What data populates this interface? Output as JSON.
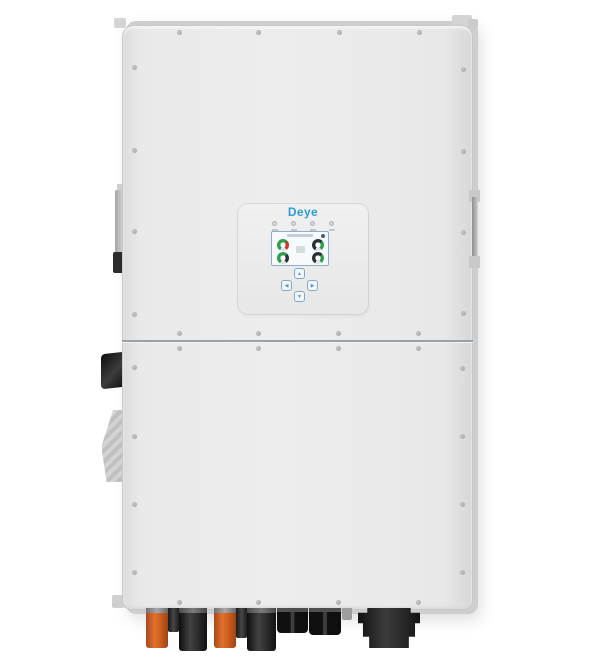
{
  "window": {
    "width": 600,
    "height": 668,
    "background": "#ffffff"
  },
  "device": {
    "name": "deye-hybrid-inverter",
    "body_color": "#e8e8e8",
    "back_plate_color": "#cdced0",
    "accent_blue": "#2e9bd6",
    "screw_color": "#a3a7aa"
  },
  "display_panel": {
    "logo_text": "Deye",
    "leds": [
      {
        "name": "led-indicator-1"
      },
      {
        "name": "led-indicator-2"
      },
      {
        "name": "led-indicator-3"
      },
      {
        "name": "led-indicator-4"
      }
    ],
    "lcd": {
      "status_dot_color": "#555a5e",
      "gauges": [
        {
          "name": "gauge-top-left",
          "colors": [
            "#2f9e4c",
            "#c43b2c"
          ]
        },
        {
          "name": "gauge-top-right",
          "colors": [
            "#2c3136",
            "#2f9e4c"
          ]
        },
        {
          "name": "gauge-bottom-left",
          "colors": [
            "#2f9e4c",
            "#2c3136"
          ]
        },
        {
          "name": "gauge-bottom-right",
          "colors": [
            "#2c3136",
            "#2f9e4c"
          ]
        }
      ]
    },
    "buttons": [
      {
        "name": "button-up",
        "symbol": "▲"
      },
      {
        "name": "button-left",
        "symbol": "◀"
      },
      {
        "name": "button-right",
        "symbol": "▶"
      },
      {
        "name": "button-down",
        "symbol": "▼"
      }
    ]
  },
  "side_components": {
    "left": [
      "handle-rail",
      "dc-switch-knob",
      "heatsink-bracket"
    ],
    "right": [
      "handle-rail"
    ]
  },
  "bottom_connectors": [
    {
      "name": "pv-connector-positive",
      "type": "mc4-orange",
      "x": 146,
      "w": 22,
      "h": 40
    },
    {
      "name": "connector-stub",
      "type": "stub-black",
      "x": 168,
      "w": 11,
      "h": 24
    },
    {
      "name": "pv-connector-negative",
      "type": "mc4-black",
      "x": 179,
      "w": 28,
      "h": 43
    },
    {
      "name": "pv-connector-positive",
      "type": "mc4-orange",
      "x": 214,
      "w": 22,
      "h": 40
    },
    {
      "name": "connector-stub",
      "type": "stub-black",
      "x": 236,
      "w": 11,
      "h": 30
    },
    {
      "name": "pv-connector-negative",
      "type": "mc4-black",
      "x": 247,
      "w": 29,
      "h": 43
    },
    {
      "name": "cable-gland-pair",
      "type": "gland-double",
      "x": 277,
      "w": 31,
      "h": 25
    },
    {
      "name": "cable-gland-pair",
      "type": "gland-double",
      "x": 309,
      "w": 32,
      "h": 27
    },
    {
      "name": "connector-stub",
      "type": "stub-gray",
      "x": 342,
      "w": 10,
      "h": 12
    },
    {
      "name": "ac-terminal-block",
      "type": "ac-main",
      "x": 358,
      "w": 62,
      "h": 40
    }
  ],
  "decorations": {
    "screws": [
      [
        179,
        32
      ],
      [
        258,
        32
      ],
      [
        339,
        32
      ],
      [
        419,
        32
      ],
      [
        134,
        67
      ],
      [
        134,
        150
      ],
      [
        134,
        231
      ],
      [
        134,
        314
      ],
      [
        463,
        69
      ],
      [
        463,
        151
      ],
      [
        463,
        232
      ],
      [
        463,
        313
      ],
      [
        179,
        333
      ],
      [
        258,
        333
      ],
      [
        338,
        333
      ],
      [
        418,
        333
      ],
      [
        179,
        348
      ],
      [
        258,
        348
      ],
      [
        338,
        348
      ],
      [
        418,
        348
      ],
      [
        134,
        367
      ],
      [
        134,
        436
      ],
      [
        134,
        504
      ],
      [
        134,
        572
      ],
      [
        462,
        368
      ],
      [
        462,
        436
      ],
      [
        462,
        504
      ],
      [
        462,
        572
      ],
      [
        179,
        602
      ],
      [
        258,
        602
      ],
      [
        338,
        602
      ],
      [
        418,
        602
      ]
    ]
  }
}
